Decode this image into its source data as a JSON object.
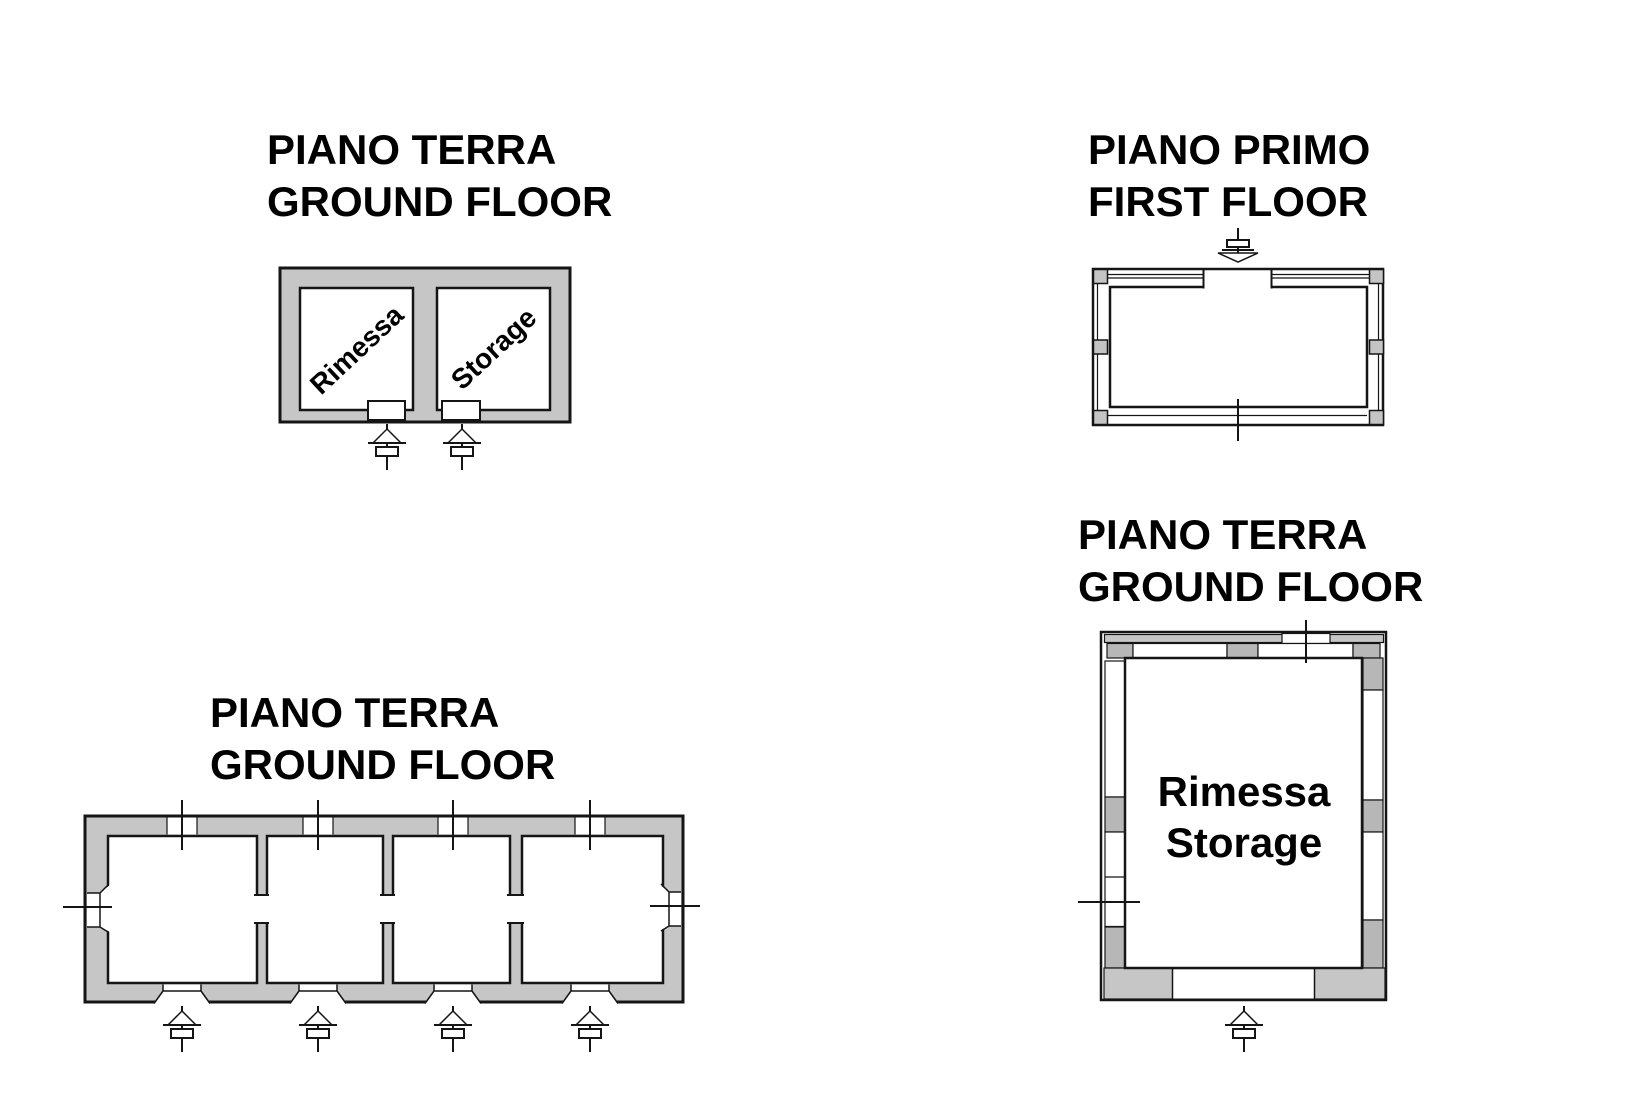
{
  "colors": {
    "wall_gray": "#c6c6c6",
    "block_gray": "#b7b7b7",
    "pillar_gray": "#c4c4c4",
    "line": "#151515"
  },
  "icons": {
    "entrance_arrow_up": "entrance-arrow-icon (survey arrow pointing up at ground-floor doors)",
    "entrance_arrow_down": "entrance-arrow-icon (survey arrow pointing down at first-floor door)",
    "wall_tick": "tick-mark crossing wall openings"
  },
  "plans": {
    "top_left": {
      "title_line1": "PIANO TERRA",
      "title_line2": "GROUND FLOOR",
      "room1_label": "Rimessa",
      "room2_label": "Storage"
    },
    "top_right": {
      "title_line1": "PIANO PRIMO",
      "title_line2": "FIRST FLOOR"
    },
    "bottom_left": {
      "title_line1": "PIANO TERRA",
      "title_line2": "GROUND FLOOR"
    },
    "bottom_right": {
      "title_line1": "PIANO TERRA",
      "title_line2": "GROUND FLOOR",
      "room_label_line1": "Rimessa",
      "room_label_line2": "Storage"
    }
  }
}
